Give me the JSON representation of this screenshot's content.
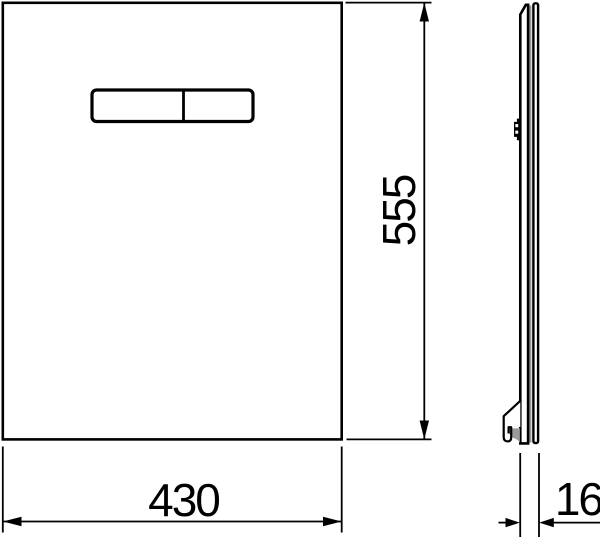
{
  "drawing": {
    "background_color": "#ffffff",
    "line_color": "#000000",
    "shading_color": "#9a9a9a",
    "views": {
      "front": {
        "name": "front-view-of-panel"
      },
      "side": {
        "name": "side-profile-view"
      }
    },
    "dimensions": {
      "width": {
        "value": "430"
      },
      "height": {
        "value": "555"
      },
      "depth": {
        "value": "16"
      }
    }
  }
}
